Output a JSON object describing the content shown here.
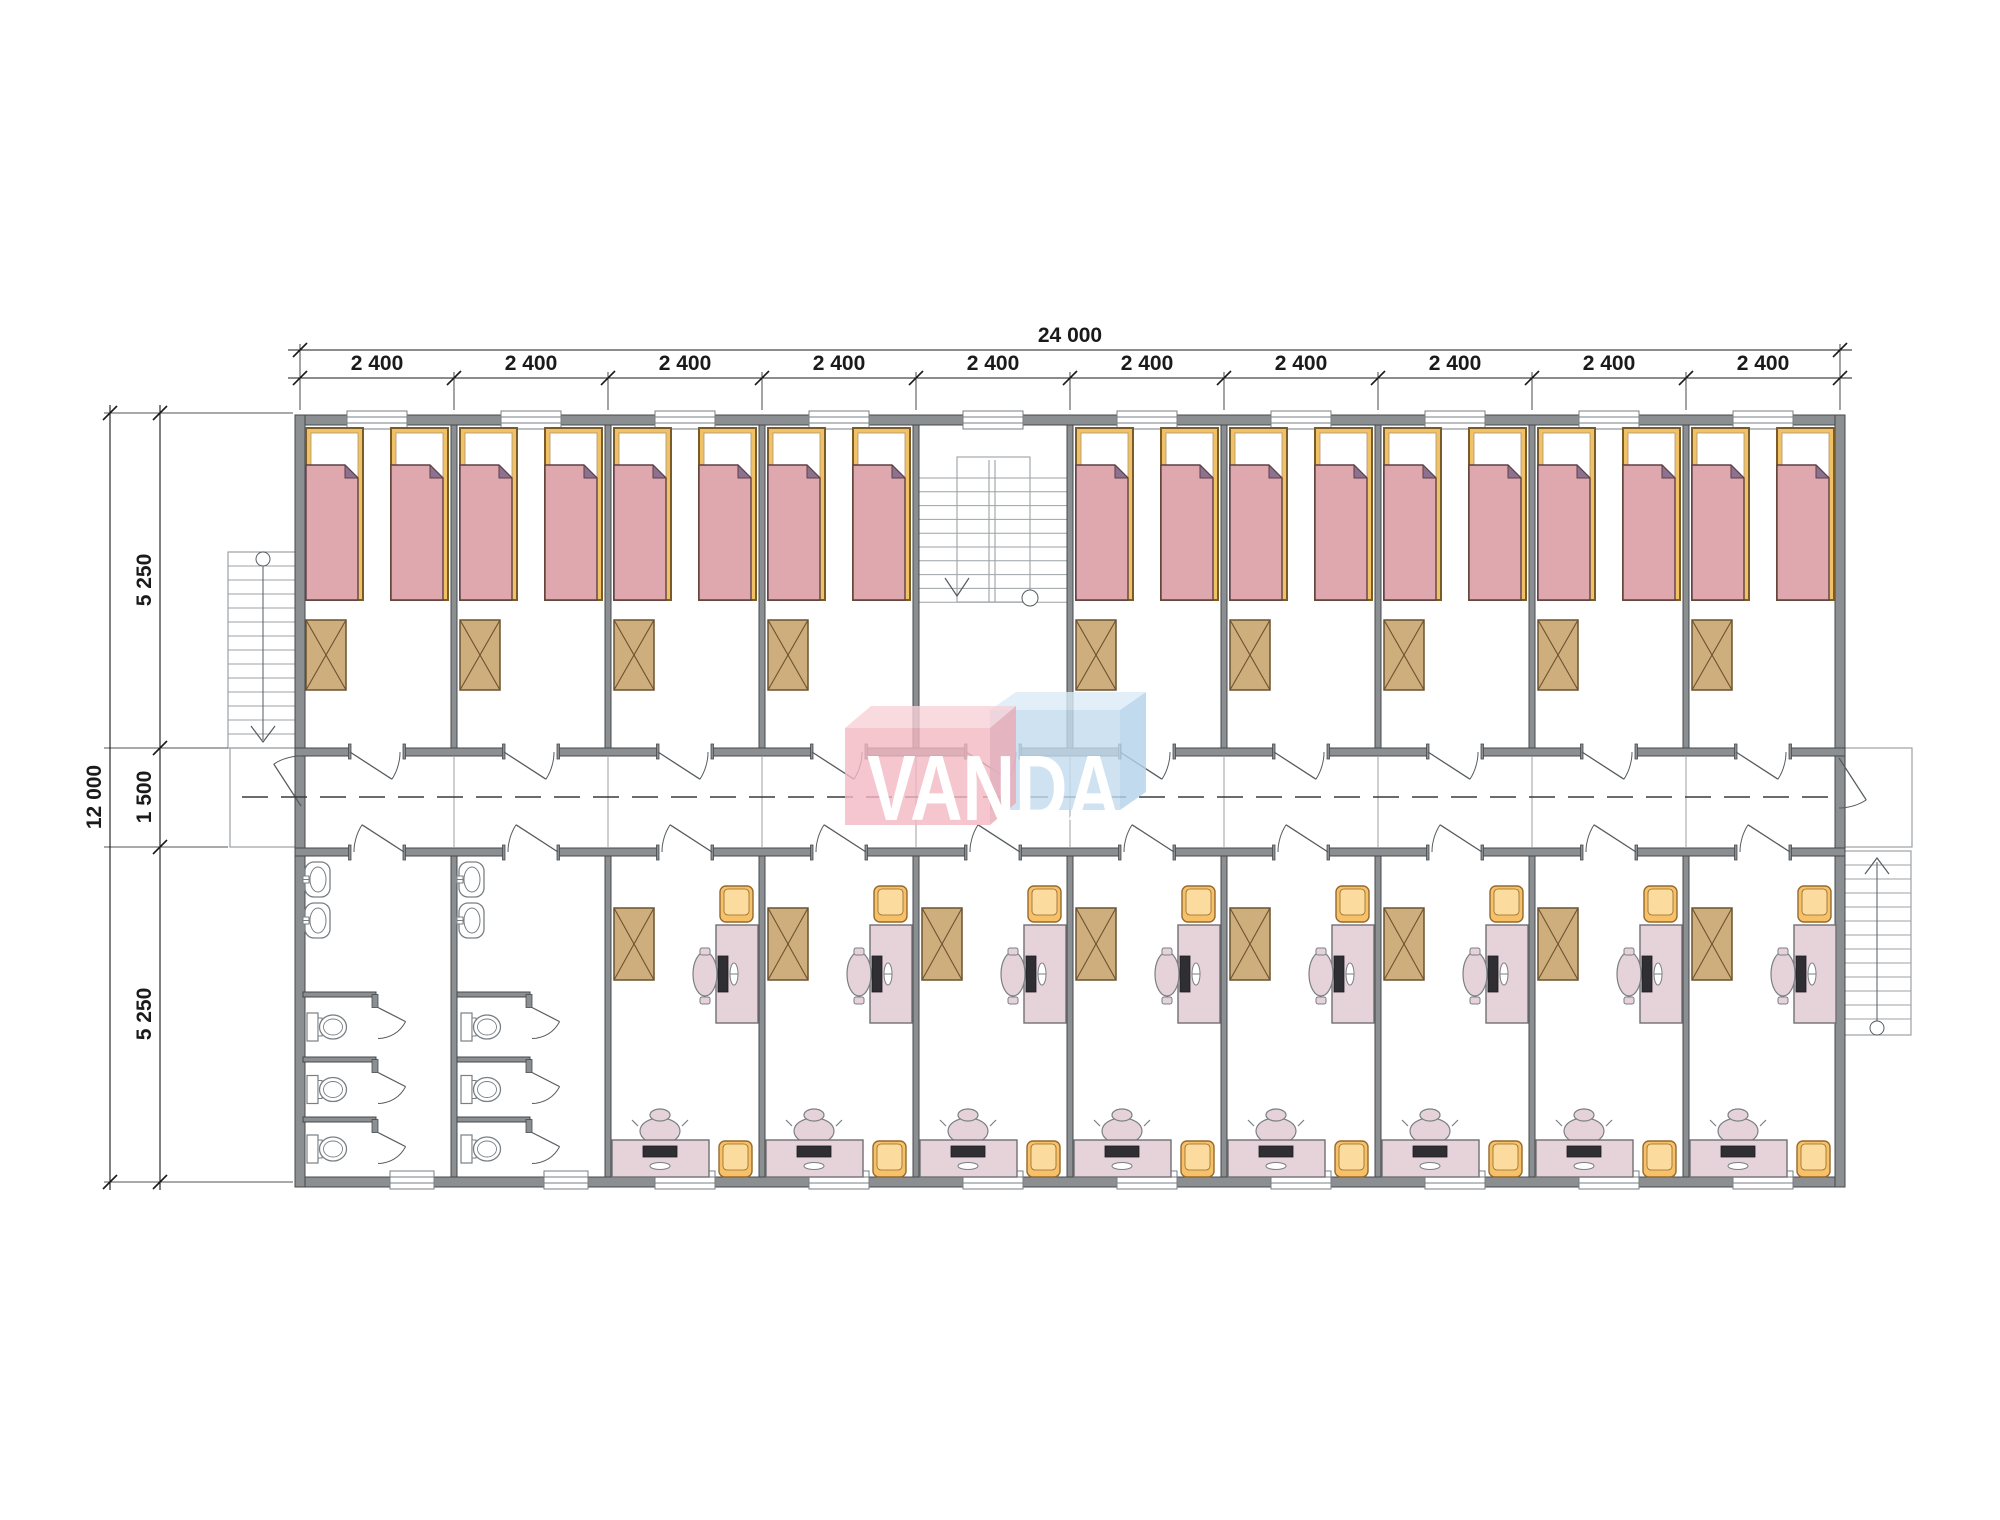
{
  "watermark": {
    "text": "VANDA",
    "pink_front": "#f3b8c3",
    "pink_top": "#f7d2d8",
    "pink_side": "#eba9b6",
    "blue_front": "#c2dcf0",
    "blue_top": "#dcecf8",
    "blue_side": "#b3d2ea",
    "text_color": "#ffffff",
    "opacity": 0.8
  },
  "dimensions": {
    "total_width_label": "24 000",
    "module_width_label": "2 400",
    "module_count": 10,
    "total_height_label": "12 000",
    "height_segment_labels": [
      "5 250",
      "1 500",
      "5 250"
    ]
  },
  "plan": {
    "bedroom_modules": [
      0,
      1,
      2,
      3,
      5,
      6,
      7,
      8,
      9
    ],
    "stair_module": 4,
    "bathroom_modules": [
      0,
      1
    ],
    "office_modules": [
      2,
      3,
      4,
      5,
      6,
      7,
      8,
      9
    ],
    "beds_per_bedroom": 2,
    "wardrobes_per_room": 1,
    "sinks_per_bathroom": 2,
    "toilets_per_bathroom": 3,
    "colors": {
      "wall": "#8b8f92",
      "wall_stroke": "#45494c",
      "bed_frame": "#f1c167",
      "bed_frame_stroke": "#7a5c28",
      "blanket": "#dfa8ae",
      "blanket_stroke": "#5d4147",
      "blanket_fold": "#8d7190",
      "pillow": "#ffffff",
      "wardrobe": "#cfae7d",
      "wardrobe_stroke": "#6b5330",
      "desk": "#e6d3da",
      "desk_stroke": "#707074",
      "stool": "#f6c169",
      "stool_light": "#fbdb9e",
      "stool_stroke": "#96692c",
      "screen": "#2e2e33",
      "fixture_stroke": "#797f83",
      "stair_stroke": "#9da2a6",
      "door": "#565b5f",
      "thin_line": "#9aa0a4",
      "centerline": "#3a3a3a",
      "dim": "#1a1a1a"
    }
  }
}
